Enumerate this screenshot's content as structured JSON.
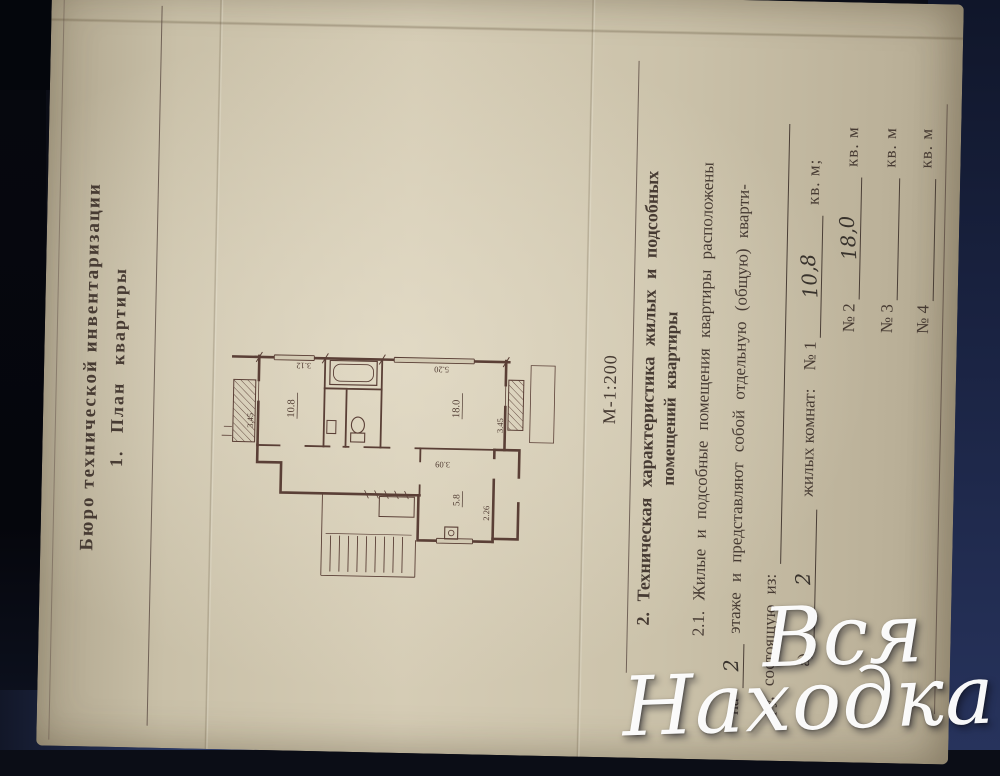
{
  "colors": {
    "background_dark": "#0b0d16",
    "background_blue": "#2e3c68",
    "background_navy": "#1a2342",
    "paper": "#cdc4ac",
    "ink": "#473b33",
    "plan_ink": "#5a3f36",
    "handwriting_ink": "#38322c",
    "watermark": "#ffffff"
  },
  "document": {
    "header": {
      "line1": "Бюро технической инвентаризации",
      "line2": "1. План квартиры"
    },
    "scale_label": "М-1:200",
    "section2": {
      "heading1": "2. Техническая характеристика жилых и подсобных",
      "heading2": "помещений квартиры",
      "line1": "2.1. Жилые и подсобные помещения квартиры расположены",
      "line2_pre": "на",
      "line2_floor": "2",
      "line2_post": "этаже и представляют собой отдельную (общую) кварти-",
      "line3": "ру, состоящую из:",
      "item_a_prefix": "а)",
      "rooms_count": "2",
      "item_a_label": "жилых комнат:",
      "rows": [
        {
          "num": "№ 1",
          "value": "10,8",
          "unit": "кв. м;"
        },
        {
          "num": "№ 2",
          "value": "18,0",
          "unit": "кв. м"
        },
        {
          "num": "№ 3",
          "value": "",
          "unit": "кв. м"
        },
        {
          "num": "№ 4",
          "value": "",
          "unit": "кв. м"
        }
      ]
    }
  },
  "plan": {
    "labels": {
      "room1_area": "10.8",
      "room1_width": "3.45",
      "room1_height": "3.12",
      "room2_area": "18.0",
      "room2_width": "3.45",
      "room2_height": "5.20",
      "kitchen_area": "5.8",
      "kitchen_height": "3.09",
      "kitchen_width": "2.26"
    }
  },
  "watermark": {
    "line1": "Вся",
    "line2": "Находка"
  }
}
